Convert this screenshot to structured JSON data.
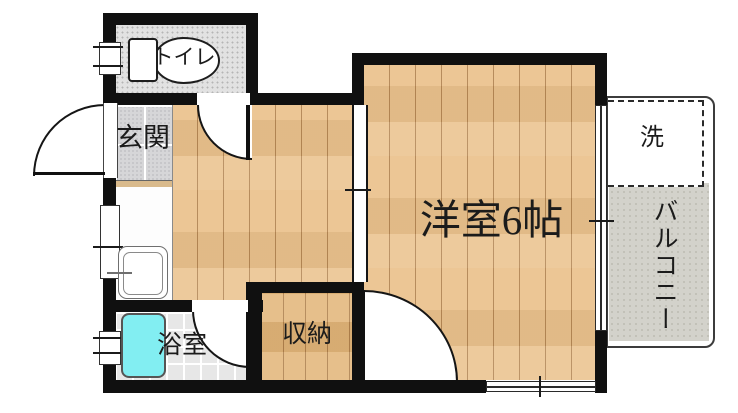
{
  "floorplan": {
    "title": "apartment-floor-plan",
    "rooms": {
      "toilet": "トイレ",
      "entrance": "玄関",
      "western_room": "洋室6帖",
      "storage": "収納",
      "bathroom": "浴室",
      "washer": "洗",
      "balcony": "バルコニー"
    },
    "colors": {
      "wall": "#101010",
      "wood_floor": "#ebc491",
      "closet_floor": "#e3b87e",
      "entrance_tile": "#d6d6d8",
      "bathroom_tile": "#e7e7e7",
      "toilet_floor": "#e2e2e2",
      "bathtub": "#82eef2",
      "balcony_concrete": "#d3d2cb"
    }
  }
}
